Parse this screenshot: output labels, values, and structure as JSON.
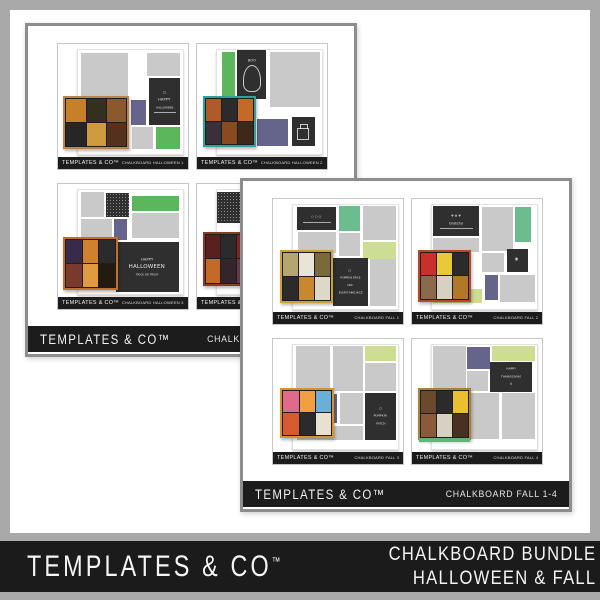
{
  "banner": {
    "brand": "TEMPLATES & CO",
    "brand_tm": "™",
    "product_line1": "CHALKBOARD BUNDLE",
    "product_line2": "HALLOWEEN & FALL"
  },
  "preview_brand": "TEMPLATES & CO™",
  "colors": {
    "frame": "#a9a9a9",
    "banner_bg": "#1b1b1b",
    "footer_bg": "#1c1c1c",
    "card_border": "#8d8d8d",
    "preview_border": "#c6c6c6",
    "page_border": "#e2e2e2",
    "gray_block": "#c9c9c9",
    "chalk": "#2f2f2f",
    "green": "#5cb75c",
    "mint": "#6cbd8d",
    "lime": "#cdde92",
    "purple": "#65658c"
  },
  "cards": [
    {
      "id": "card-chalkboard-halloween",
      "x": 25,
      "y": 23,
      "z": 1,
      "banner_brand": "TEMPLATES & CO™",
      "banner_label": "CHALKBOARD HALLOWEEN 1-4",
      "templates": [
        {
          "name": "CHALKBOARD HALLOWEEN 1",
          "blocks": [
            {
              "t": "gray",
              "x": 3,
              "y": 3,
              "w": 45,
              "h": 72
            },
            {
              "t": "gray",
              "x": 66,
              "y": 3,
              "w": 31,
              "h": 22
            },
            {
              "t": "chalk",
              "x": 68,
              "y": 27,
              "w": 29,
              "h": 45,
              "lines": [
                [
                  "○",
                  4
                ],
                [
                  "HAPPY",
                  3.6
                ],
                [
                  "HALLOWEEN",
                  2.6
                ]
              ],
              "line": true
            },
            {
              "t": "purple",
              "x": 50,
              "y": 48,
              "w": 15,
              "h": 24
            },
            {
              "t": "gray",
              "x": 51,
              "y": 74,
              "w": 20,
              "h": 21
            },
            {
              "t": "green",
              "x": 74,
              "y": 74,
              "w": 23,
              "h": 21
            },
            {
              "t": "collage",
              "x": -14,
              "y": 44,
              "w": 63,
              "h": 51,
              "border": "#b9854d",
              "cells": [
                "#c77f2a",
                "#33301f",
                "#8a5a2e",
                "#262626",
                "#d09a3e",
                "#55301f"
              ]
            }
          ]
        },
        {
          "name": "CHALKBOARD HALLOWEEN 2",
          "blocks": [
            {
              "t": "green",
              "x": 5,
              "y": 2,
              "w": 12,
              "h": 42
            },
            {
              "t": "chalk",
              "x": 19,
              "y": 0,
              "w": 28,
              "h": 47,
              "lines": [
                [
                  "BOO",
                  3.4
                ]
              ],
              "art": "ghost"
            },
            {
              "t": "gray",
              "x": 50,
              "y": 2,
              "w": 48,
              "h": 53
            },
            {
              "t": "gray",
              "x": 5,
              "y": 46,
              "w": 12,
              "h": 28
            },
            {
              "t": "purple",
              "x": 38,
              "y": 66,
              "w": 30,
              "h": 26
            },
            {
              "t": "chalk",
              "x": 71,
              "y": 64,
              "w": 22,
              "h": 28,
              "art": "cake"
            },
            {
              "t": "collage",
              "x": -13,
              "y": 44,
              "w": 50,
              "h": 49,
              "border": "#2ea19a",
              "cells": [
                "#b05a2a",
                "#2b2b2b",
                "#c46a28",
                "#3a2f3a",
                "#8a4a20",
                "#402818"
              ]
            }
          ]
        },
        {
          "name": "CHALKBOARD HALLOWEEN 3",
          "blocks": [
            {
              "t": "gray",
              "x": 3,
              "y": 2,
              "w": 22,
              "h": 24
            },
            {
              "t": "chalk",
              "x": 27,
              "y": 3,
              "w": 22,
              "h": 23,
              "tex": true
            },
            {
              "t": "green",
              "x": 51,
              "y": 6,
              "w": 45,
              "h": 14
            },
            {
              "t": "gray",
              "x": 3,
              "y": 28,
              "w": 29,
              "h": 18
            },
            {
              "t": "purple",
              "x": 34,
              "y": 28,
              "w": 13,
              "h": 20
            },
            {
              "t": "gray",
              "x": 51,
              "y": 22,
              "w": 45,
              "h": 24
            },
            {
              "t": "chalk",
              "x": 36,
              "y": 50,
              "w": 60,
              "h": 48,
              "lines": [
                [
                  "HAPPY",
                  3.6
                ],
                [
                  "HALLOWEEN",
                  5.5
                ],
                [
                  "TRICK OR TREAT",
                  2.6
                ]
              ]
            },
            {
              "t": "collage",
              "x": -14,
              "y": 45,
              "w": 52,
              "h": 51,
              "border": "#c0702e",
              "cells": [
                "#3a2a4a",
                "#d0812e",
                "#2b2b2b",
                "#7a3a2a",
                "#e09a40",
                "#241a10"
              ]
            }
          ]
        },
        {
          "name": "CHALKBOARD HALLOWEEN 4",
          "blocks": [
            {
              "t": "chalk",
              "x": 0,
              "y": 2,
              "w": 28,
              "h": 30,
              "tex": true
            },
            {
              "t": "gray",
              "x": 31,
              "y": 2,
              "w": 42,
              "h": 30
            },
            {
              "t": "gray",
              "x": 76,
              "y": 2,
              "w": 22,
              "h": 40
            },
            {
              "t": "gray",
              "x": 31,
              "y": 35,
              "w": 30,
              "h": 22
            },
            {
              "t": "purple",
              "x": 42,
              "y": 62,
              "w": 22,
              "h": 24
            },
            {
              "t": "chalk",
              "x": 68,
              "y": 56,
              "w": 28,
              "h": 34,
              "lines": [
                [
                  "✧",
                  4
                ]
              ]
            },
            {
              "t": "collage",
              "x": -13,
              "y": 40,
              "w": 48,
              "h": 52,
              "border": "#8a3a2a",
              "cells": [
                "#5a1f1f",
                "#2b2b2b",
                "#8a2525",
                "#c46a28",
                "#33262b",
                "#6a3a4a"
              ]
            }
          ]
        }
      ]
    },
    {
      "id": "card-chalkboard-fall",
      "x": 240,
      "y": 178,
      "z": 2,
      "banner_brand": "TEMPLATES & CO™",
      "banner_label": "CHALKBOARD FALL 1-4",
      "templates": [
        {
          "name": "CHALKBOARD FALL 1",
          "blocks": [
            {
              "t": "chalk",
              "x": 4,
              "y": 2,
              "w": 37,
              "h": 22,
              "lines": [
                [
                  "○ ○ ○",
                  3
                ]
              ],
              "line": true
            },
            {
              "t": "mint",
              "x": 44,
              "y": 1,
              "w": 20,
              "h": 24
            },
            {
              "t": "gray",
              "x": 67,
              "y": 1,
              "w": 31,
              "h": 33
            },
            {
              "t": "gray",
              "x": 5,
              "y": 26,
              "w": 36,
              "h": 20
            },
            {
              "t": "gray",
              "x": 44,
              "y": 27,
              "w": 20,
              "h": 22
            },
            {
              "t": "lime",
              "x": 67,
              "y": 36,
              "w": 31,
              "h": 16
            },
            {
              "t": "chalk",
              "x": 38,
              "y": 51,
              "w": 33,
              "h": 46,
              "lines": [
                [
                  "○",
                  3.4
                ],
                [
                  "PUMPKIN SPICE",
                  2.5
                ],
                [
                  "AND",
                  2.3
                ],
                [
                  "EVERYTHING NICE",
                  2.5
                ]
              ]
            },
            {
              "t": "gray",
              "x": 73,
              "y": 52,
              "w": 25,
              "h": 45
            },
            {
              "t": "collage",
              "x": -12,
              "y": 43,
              "w": 50,
              "h": 51,
              "border": "#c9a23a",
              "cells": [
                "#b5a66e",
                "#e8e4d8",
                "#7a6a3a",
                "#2b2b2b",
                "#c9882e",
                "#ddd8c8"
              ]
            }
          ]
        },
        {
          "name": "CHALKBOARD FALL 2",
          "blocks": [
            {
              "t": "chalk",
              "x": 1,
              "y": 1,
              "w": 44,
              "h": 29,
              "lines": [
                [
                  "✾ ✿ ✾",
                  3
                ],
                [
                  "Grateful",
                  3.2
                ]
              ],
              "line": true
            },
            {
              "t": "gray",
              "x": 1,
              "y": 32,
              "w": 44,
              "h": 13
            },
            {
              "t": "gray",
              "x": 48,
              "y": 2,
              "w": 29,
              "h": 42
            },
            {
              "t": "mint",
              "x": 79,
              "y": 2,
              "w": 15,
              "h": 34
            },
            {
              "t": "gray",
              "x": 48,
              "y": 46,
              "w": 21,
              "h": 18
            },
            {
              "t": "chalk",
              "x": 71,
              "y": 42,
              "w": 20,
              "h": 22,
              "lines": [
                [
                  "❀",
                  4.5
                ]
              ]
            },
            {
              "t": "purple",
              "x": 50,
              "y": 67,
              "w": 13,
              "h": 24
            },
            {
              "t": "gray",
              "x": 65,
              "y": 67,
              "w": 33,
              "h": 26
            },
            {
              "t": "lime",
              "x": 1,
              "y": 81,
              "w": 47,
              "h": 13
            },
            {
              "t": "collage",
              "x": -13,
              "y": 43,
              "w": 50,
              "h": 50,
              "border": "#b54a26",
              "cells": [
                "#c9302a",
                "#e8c93a",
                "#2b2b2b",
                "#8a6a4a",
                "#d8d0c0",
                "#b07828"
              ]
            }
          ]
        },
        {
          "name": "CHALKBOARD FALL 3",
          "blocks": [
            {
              "t": "gray",
              "x": 3,
              "y": 1,
              "w": 32,
              "h": 43
            },
            {
              "t": "gray",
              "x": 38,
              "y": 1,
              "w": 29,
              "h": 43
            },
            {
              "t": "lime",
              "x": 69,
              "y": 1,
              "w": 29,
              "h": 14
            },
            {
              "t": "gray",
              "x": 69,
              "y": 17,
              "w": 29,
              "h": 27
            },
            {
              "t": "purple",
              "x": 30,
              "y": 47,
              "w": 12,
              "h": 28
            },
            {
              "t": "gray",
              "x": 45,
              "y": 46,
              "w": 22,
              "h": 30
            },
            {
              "t": "chalk",
              "x": 69,
              "y": 46,
              "w": 29,
              "h": 45,
              "lines": [
                [
                  "○",
                  3.4
                ],
                [
                  "PUMPKIN",
                  2.8
                ],
                [
                  "PATCH",
                  2.8
                ]
              ]
            },
            {
              "t": "gray",
              "x": 4,
              "y": 78,
              "w": 63,
              "h": 13
            },
            {
              "t": "collage",
              "x": -12,
              "y": 41,
              "w": 51,
              "h": 48,
              "border": "#d9912e",
              "cells": [
                "#e06a8a",
                "#f0a040",
                "#68b0d8",
                "#d85a30",
                "#2b2b2b",
                "#e8e0d0"
              ]
            }
          ]
        },
        {
          "name": "CHALKBOARD FALL 4",
          "blocks": [
            {
              "t": "gray",
              "x": 1,
              "y": 1,
              "w": 31,
              "h": 43
            },
            {
              "t": "purple",
              "x": 33,
              "y": 2,
              "w": 22,
              "h": 21
            },
            {
              "t": "lime",
              "x": 57,
              "y": 1,
              "w": 41,
              "h": 14
            },
            {
              "t": "chalk",
              "x": 55,
              "y": 16,
              "w": 40,
              "h": 29,
              "lines": [
                [
                  "HAPPY",
                  2.8
                ],
                [
                  "THANKSGIVING",
                  2.5
                ],
                [
                  "⌂",
                  3.4
                ]
              ]
            },
            {
              "t": "gray",
              "x": 33,
              "y": 25,
              "w": 20,
              "h": 19
            },
            {
              "t": "gray",
              "x": 33,
              "y": 46,
              "w": 31,
              "h": 44
            },
            {
              "t": "gray",
              "x": 67,
              "y": 46,
              "w": 31,
              "h": 44
            },
            {
              "t": "collage",
              "x": -13,
              "y": 41,
              "w": 50,
              "h": 50,
              "border": "#a8842e",
              "cells": [
                "#6a4a2e",
                "#2b2b2b",
                "#e8c030",
                "#8a5a3a",
                "#d8d0c0",
                "#4a3020"
              ],
              "strip": "#5fb878"
            }
          ]
        }
      ]
    }
  ]
}
